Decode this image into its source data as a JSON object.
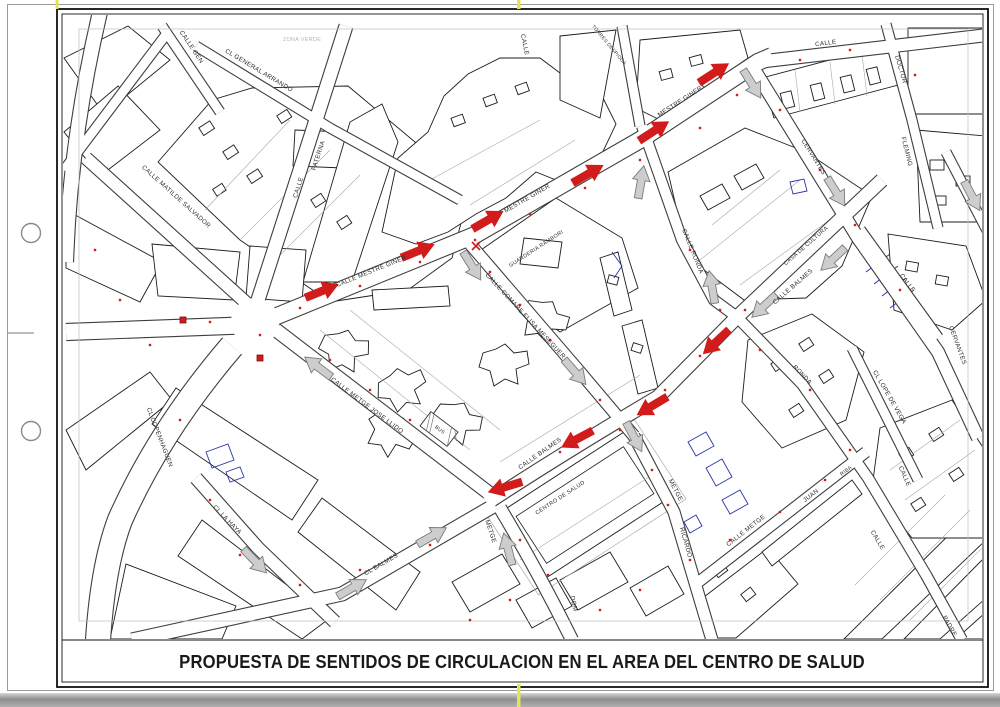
{
  "page": {
    "bottom_title": "PROPUESTA DE SENTIDOS DE CIRCULACION EN EL AREA DEL CENTRO DE SALUD"
  },
  "colors": {
    "red": "#d21c1c",
    "gray_arrow": "#cdcdcd",
    "gray_arrow_border": "#7d7d7d",
    "label": "#2e2e2e",
    "faint_label": "#b4b4b4",
    "blue": "#2a35a8",
    "yellow_mark": "#e3e45c"
  },
  "map": {
    "street_labels": [
      {
        "t": "CALLE GEN",
        "x": 190,
        "y": 48,
        "r": 56
      },
      {
        "t": "CL GENERAL ARRANDO",
        "x": 258,
        "y": 72,
        "r": 31
      },
      {
        "t": "ZONA VERDE",
        "x": 302,
        "y": 41,
        "r": 0,
        "c": "faint_label",
        "s": 5.5
      },
      {
        "t": "CALLE",
        "x": 300,
        "y": 188,
        "r": -72
      },
      {
        "t": "PATERNA",
        "x": 320,
        "y": 156,
        "r": -72
      },
      {
        "t": "CALLE MATILDE SALVADOR",
        "x": 175,
        "y": 198,
        "r": 42
      },
      {
        "t": "CALLE MESTRE GINER",
        "x": 372,
        "y": 273,
        "r": -22
      },
      {
        "t": "MESTRE GINER",
        "x": 528,
        "y": 200,
        "r": -30
      },
      {
        "t": "MESTRE GINER",
        "x": 681,
        "y": 103,
        "r": -33
      },
      {
        "t": "GUARDERIA RAMBORI",
        "x": 537,
        "y": 250,
        "r": -33,
        "s": 5.4
      },
      {
        "t": "CALLE COMARE ELISA MESEGUER",
        "x": 524,
        "y": 317,
        "r": 47
      },
      {
        "t": "CALLE RONDA",
        "x": 691,
        "y": 252,
        "r": 68
      },
      {
        "t": "CALLE BALMES",
        "x": 794,
        "y": 288,
        "r": -41
      },
      {
        "t": "CASA DE CULTURA",
        "x": 807,
        "y": 247,
        "r": -41,
        "s": 5.6
      },
      {
        "t": "CALLE BALMES",
        "x": 541,
        "y": 455,
        "r": -35
      },
      {
        "t": "CENTRO DE SALUD",
        "x": 561,
        "y": 499,
        "r": -33,
        "s": 5.6
      },
      {
        "t": "CALLE METGE JOSE LLIDO",
        "x": 366,
        "y": 407,
        "r": 37
      },
      {
        "t": "BUS",
        "x": 439,
        "y": 431,
        "r": 37,
        "s": 5
      },
      {
        "t": "CL COPENHAGUEN",
        "x": 158,
        "y": 438,
        "r": 69
      },
      {
        "t": "CL LA HAYA",
        "x": 226,
        "y": 521,
        "r": 46
      },
      {
        "t": "CL BALMES",
        "x": 382,
        "y": 566,
        "r": -30
      },
      {
        "t": "METGE",
        "x": 489,
        "y": 532,
        "r": 72
      },
      {
        "t": "DOM",
        "x": 572,
        "y": 604,
        "r": 78
      },
      {
        "t": "METGE",
        "x": 674,
        "y": 491,
        "r": 62
      },
      {
        "t": "RICARDO",
        "x": 684,
        "y": 543,
        "r": 74
      },
      {
        "t": "CALLE METGE",
        "x": 747,
        "y": 532,
        "r": -38
      },
      {
        "t": "JUAN",
        "x": 812,
        "y": 497,
        "r": -38
      },
      {
        "t": "RIBA",
        "x": 847,
        "y": 472,
        "r": -38,
        "s": 5.2
      },
      {
        "t": "CL LOPE DE VEGA",
        "x": 888,
        "y": 398,
        "r": 60
      },
      {
        "t": "RONDA",
        "x": 801,
        "y": 376,
        "r": 46
      },
      {
        "t": "CERVANTES",
        "x": 812,
        "y": 158,
        "r": 58
      },
      {
        "t": "CERVANTES",
        "x": 956,
        "y": 346,
        "r": 70
      },
      {
        "t": "CALLE",
        "x": 826,
        "y": 45,
        "r": -7
      },
      {
        "t": "DOCTOR",
        "x": 899,
        "y": 70,
        "r": 74
      },
      {
        "t": "FLEMING",
        "x": 905,
        "y": 152,
        "r": 76
      },
      {
        "t": "CALLE",
        "x": 906,
        "y": 284,
        "r": 53
      },
      {
        "t": "CALLE",
        "x": 903,
        "y": 477,
        "r": 66
      },
      {
        "t": "CALLE",
        "x": 876,
        "y": 541,
        "r": 59
      },
      {
        "t": "PADRE",
        "x": 948,
        "y": 627,
        "r": 60
      },
      {
        "t": "TORRES DESPIOCA",
        "x": 608,
        "y": 46,
        "r": 50,
        "s": 4.8
      },
      {
        "t": "CALLE",
        "x": 523,
        "y": 45,
        "r": 78
      }
    ],
    "arrows": {
      "red": [
        [
          322,
          291,
          -22
        ],
        [
          418,
          251,
          -22
        ],
        [
          488,
          220,
          -30
        ],
        [
          588,
          174,
          -30
        ],
        [
          654,
          131,
          -33
        ],
        [
          714,
          73,
          -33
        ],
        [
          716,
          342,
          137
        ],
        [
          652,
          406,
          149
        ],
        [
          577,
          439,
          152
        ],
        [
          505,
          487,
          163
        ]
      ],
      "gray": [
        [
          318,
          367,
          217
        ],
        [
          352,
          588,
          -30
        ],
        [
          432,
          536,
          -30
        ],
        [
          508,
          549,
          -105
        ],
        [
          575,
          372,
          49
        ],
        [
          472,
          266,
          58
        ],
        [
          634,
          437,
          62
        ],
        [
          641,
          182,
          -80
        ],
        [
          712,
          287,
          -100
        ],
        [
          752,
          84,
          58
        ],
        [
          836,
          192,
          58
        ],
        [
          972,
          196,
          62
        ],
        [
          833,
          259,
          137
        ],
        [
          764,
          306,
          137
        ],
        [
          255,
          561,
          46
        ]
      ]
    },
    "red_dots": [
      [
        300,
        308
      ],
      [
        360,
        286
      ],
      [
        420,
        262
      ],
      [
        475,
        240
      ],
      [
        530,
        214
      ],
      [
        585,
        188
      ],
      [
        640,
        160
      ],
      [
        700,
        128
      ],
      [
        737,
        95
      ],
      [
        260,
        335
      ],
      [
        210,
        322
      ],
      [
        120,
        300
      ],
      [
        95,
        250
      ],
      [
        150,
        345
      ],
      [
        180,
        420
      ],
      [
        210,
        500
      ],
      [
        240,
        555
      ],
      [
        745,
        310
      ],
      [
        700,
        356
      ],
      [
        665,
        390
      ],
      [
        620,
        430
      ],
      [
        560,
        452
      ],
      [
        520,
        480
      ],
      [
        490,
        272
      ],
      [
        520,
        305
      ],
      [
        550,
        340
      ],
      [
        600,
        400
      ],
      [
        330,
        360
      ],
      [
        370,
        390
      ],
      [
        410,
        420
      ],
      [
        360,
        570
      ],
      [
        300,
        585
      ],
      [
        430,
        545
      ],
      [
        520,
        540
      ],
      [
        548,
        575
      ],
      [
        652,
        470
      ],
      [
        668,
        505
      ],
      [
        690,
        560
      ],
      [
        730,
        540
      ],
      [
        780,
        512
      ],
      [
        825,
        480
      ],
      [
        690,
        250
      ],
      [
        720,
        310
      ],
      [
        760,
        350
      ],
      [
        810,
        390
      ],
      [
        850,
        450
      ],
      [
        780,
        110
      ],
      [
        820,
        170
      ],
      [
        855,
        225
      ],
      [
        900,
        290
      ],
      [
        470,
        620
      ],
      [
        510,
        600
      ],
      [
        600,
        610
      ],
      [
        640,
        590
      ],
      [
        800,
        60
      ],
      [
        850,
        50
      ],
      [
        915,
        75
      ]
    ],
    "markers": [
      {
        "t": "sq",
        "x": 183,
        "y": 320
      },
      {
        "t": "sq",
        "x": 260,
        "y": 358
      },
      {
        "t": "x",
        "x": 476,
        "y": 246
      }
    ]
  }
}
